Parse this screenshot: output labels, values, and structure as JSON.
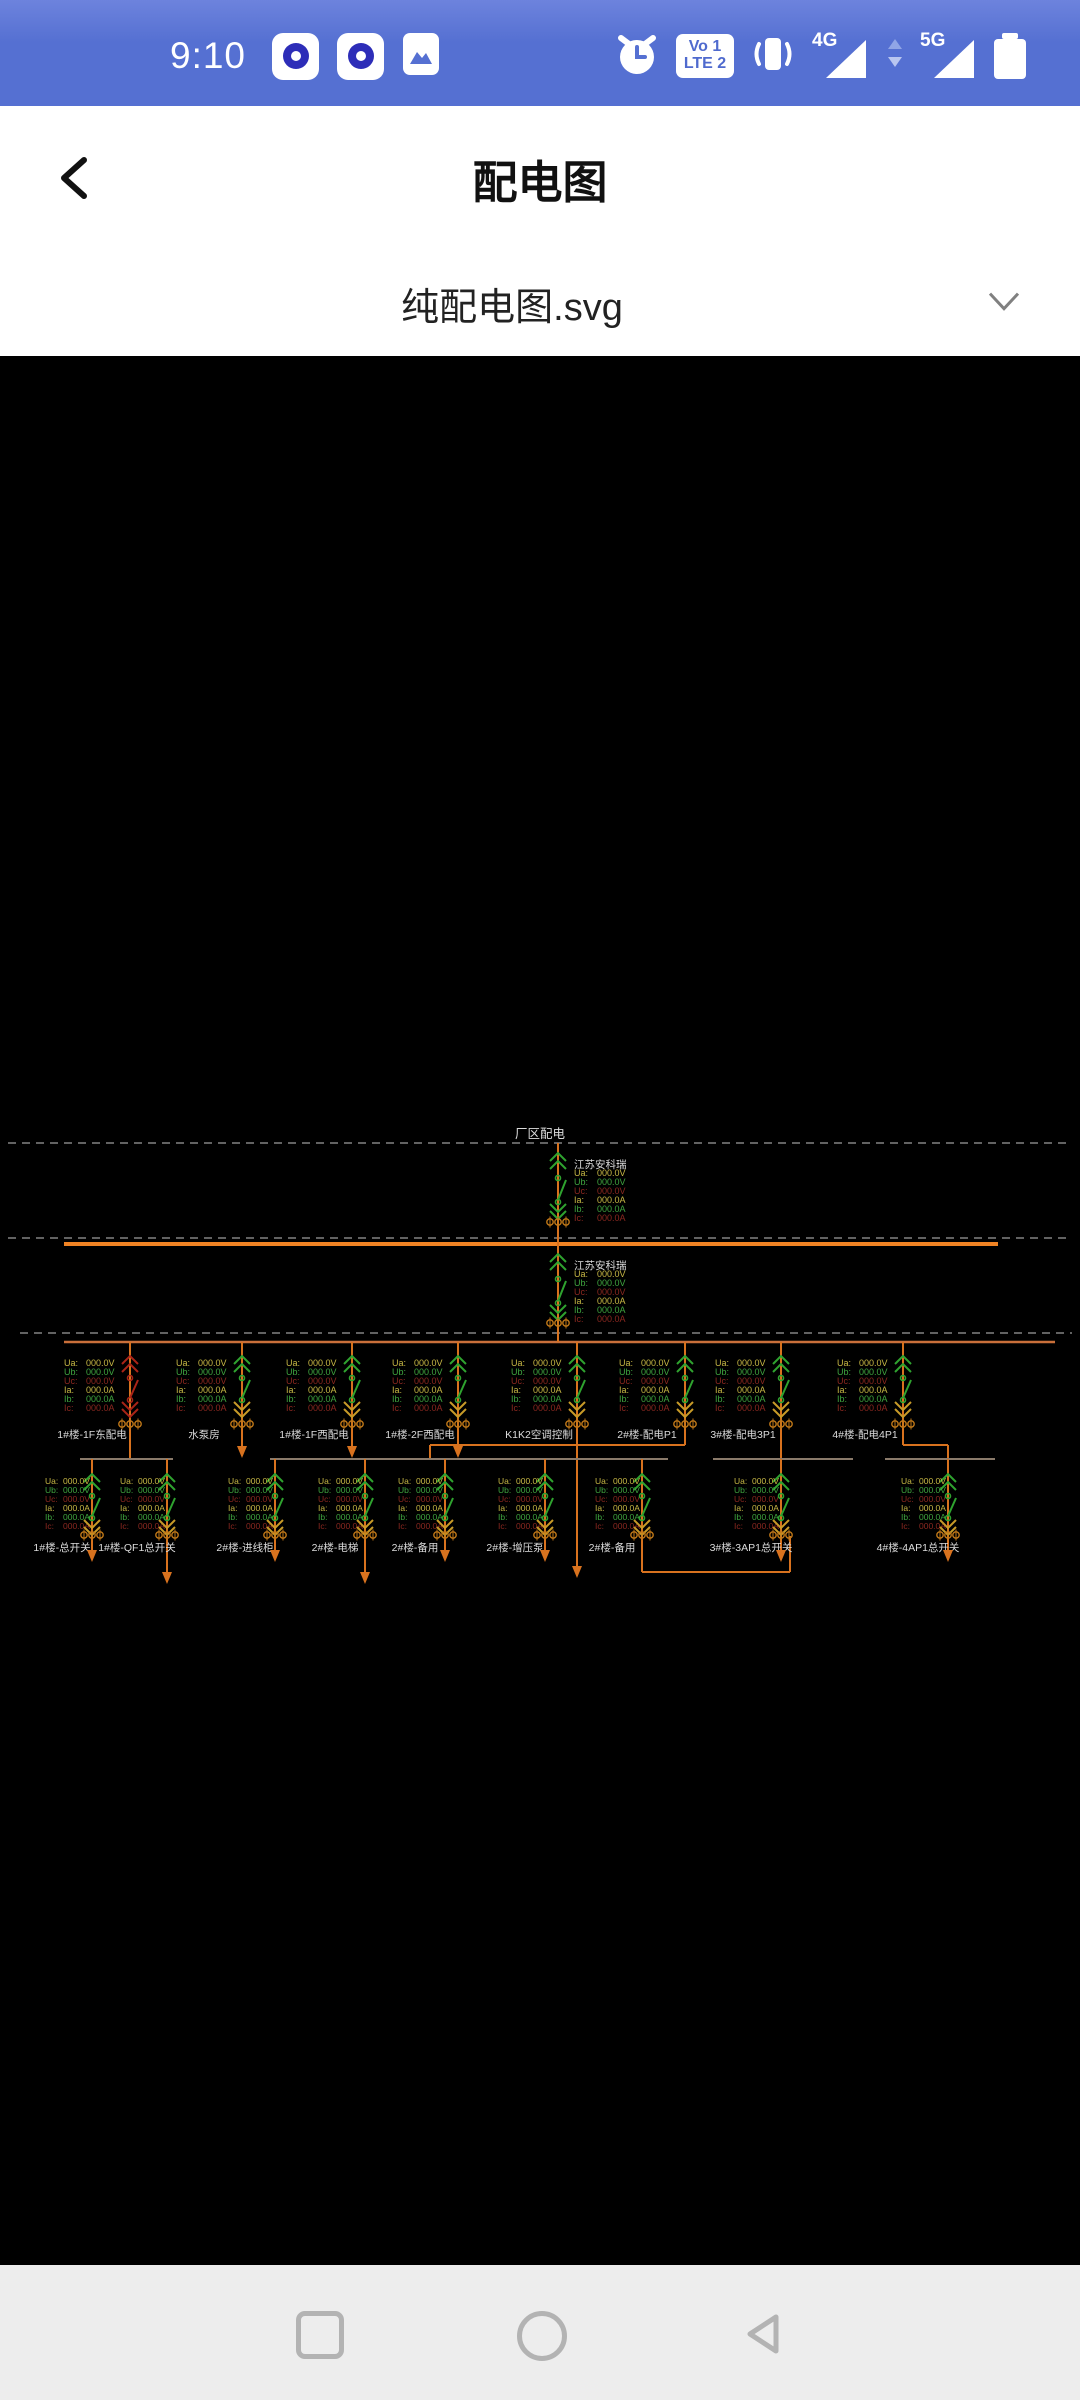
{
  "status_bar": {
    "time": "9:10",
    "volte_top": "Vo 1",
    "volte_bottom": "LTE 2",
    "network_4g": "4G",
    "network_5g": "5G",
    "icons": [
      "notification-app-icon",
      "notification-app-icon",
      "gallery-icon",
      "alarm-icon",
      "volte-icon",
      "vibrate-icon",
      "signal-4g-icon",
      "updown-arrows-icon",
      "signal-5g-icon",
      "battery-icon"
    ]
  },
  "header": {
    "title": "配电图"
  },
  "file_selector": {
    "value": "纯配电图.svg"
  },
  "nav_bar": {
    "icons": [
      "recents-square-icon",
      "home-circle-icon",
      "back-triangle-icon"
    ]
  },
  "colors": {
    "status_blue": "#5570d2",
    "phase_a": "#c9b945",
    "phase_b": "#3fa53f",
    "phase_c": "#8c2820",
    "label_white": "#dcdcdc",
    "line_orange": "#d8721e",
    "bus_primary": "#f08324",
    "bus_secondary": "#c96f3a",
    "sub_bus": "#8a7a6a",
    "meter_orange": "#c07818",
    "symbol_green": "#2fa32f",
    "symbol_red": "#aa2418",
    "chevron_yellow": "#c89b28",
    "dashed_line": "#c4c4c4"
  },
  "diagram": {
    "site_label": "厂区配电",
    "incomers": [
      {
        "label": "江苏安科瑞"
      },
      {
        "label": "江苏安科瑞"
      }
    ],
    "readings": [
      {
        "key": "Ua:",
        "value": "000.0V",
        "phase": "a"
      },
      {
        "key": "Ub:",
        "value": "000.0V",
        "phase": "b"
      },
      {
        "key": "Uc:",
        "value": "000.0V",
        "phase": "c"
      },
      {
        "key": "Ia:",
        "value": "000.0A",
        "phase": "a"
      },
      {
        "key": "Ib:",
        "value": "000.0A",
        "phase": "b"
      },
      {
        "key": "Ic:",
        "value": "000.0A",
        "phase": "c"
      }
    ],
    "tier1_feeders": [
      {
        "label": "1#楼-1F东配电",
        "x": 130,
        "state": "alarm",
        "drop": "subbus"
      },
      {
        "label": "水泵房",
        "x": 242,
        "drop": "arrow"
      },
      {
        "label": "1#楼-1F西配电",
        "x": 352,
        "drop": "arrow"
      },
      {
        "label": "1#楼-2F西配电",
        "x": 458,
        "drop": "arrow"
      },
      {
        "label": "K1K2空调控制",
        "x": 577,
        "drop": "longarrow"
      },
      {
        "label": "2#楼-配电P1",
        "x": 685,
        "drop": "jogleft",
        "jog_to": 430
      },
      {
        "label": "3#楼-配电3P1",
        "x": 781,
        "drop": "subbus"
      },
      {
        "label": "4#楼-配电4P1",
        "x": 903,
        "drop": "jogright",
        "jog_to": 948
      }
    ],
    "sub_buses": [
      {
        "name": "A",
        "x1": 80,
        "x2": 173
      },
      {
        "name": "B",
        "x1": 270,
        "x2": 668
      },
      {
        "name": "C",
        "x1": 713,
        "x2": 853
      },
      {
        "name": "D",
        "x1": 885,
        "x2": 995
      }
    ],
    "tier2_feeders": [
      {
        "label": "1#楼-总开关",
        "x": 92,
        "tail": "arrow"
      },
      {
        "label": "1#楼-QF1总开关",
        "x": 167,
        "tail": "longarrow"
      },
      {
        "label": "2#楼-进线柜",
        "x": 275,
        "tail": "arrow"
      },
      {
        "label": "2#楼-电梯",
        "x": 365,
        "tail": "longarrow"
      },
      {
        "label": "2#楼-备用",
        "x": 445,
        "tail": "arrow"
      },
      {
        "label": "2#楼-增压泵",
        "x": 545,
        "tail": "arrow"
      },
      {
        "label": "2#楼-备用",
        "x": 642,
        "tail": "tie",
        "tie_to": 790
      },
      {
        "label": "3#楼-3AP1总开关",
        "x": 781,
        "tail": "arrow"
      },
      {
        "label": "4#楼-4AP1总开关",
        "x": 948,
        "tail": "arrow"
      }
    ]
  }
}
